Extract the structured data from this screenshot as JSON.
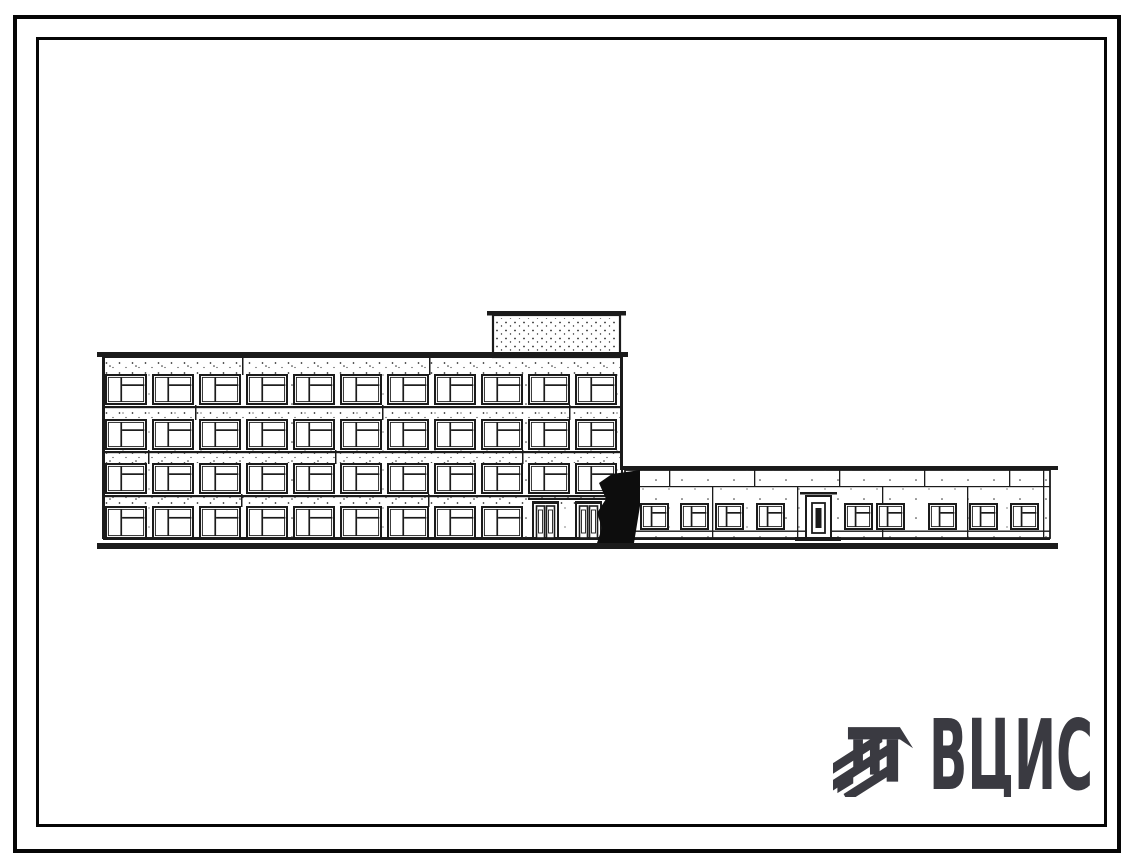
{
  "logo": {
    "text": "ВЦИС",
    "color": "#3a3a41",
    "icon": "hatched-shield-icon"
  },
  "drawing": {
    "subject": "Front elevation of a four-storey building with a roof penthouse and an attached single-storey wing",
    "main_block": {
      "floors": 4,
      "windows_per_upper_floor": 11,
      "ground_floor_windows": 9,
      "entrance_double_doors": 2,
      "roof_penthouse": 1
    },
    "wing": {
      "floors": 1,
      "windows": 9,
      "doors": 1
    },
    "geometry": {
      "ink": "#1b1b1b",
      "main": {
        "x": 103,
        "top": 357,
        "w": 519,
        "bottom": 538,
        "cap": [
          97,
          352,
          531,
          5
        ],
        "rows": [
          {
            "y": 375,
            "h": 29,
            "n": 11,
            "s": 1
          },
          {
            "y": 420,
            "h": 29,
            "n": 11,
            "s": 1
          },
          {
            "y": 464,
            "h": 29,
            "n": 11,
            "s": 1
          },
          {
            "y": 507,
            "h": 31,
            "n": 9,
            "s": 0
          }
        ],
        "win": {
          "x0": 106,
          "w": 40,
          "pitch": 47
        },
        "bands": [
          [
            359,
            15
          ],
          [
            406,
            13
          ],
          [
            451,
            12
          ],
          [
            495,
            11
          ]
        ],
        "band_joints": [
          [
            242,
            429
          ],
          [
            195,
            382,
            569
          ],
          [
            148,
            335,
            522
          ],
          [
            241,
            428,
            615
          ]
        ],
        "doors": {
          "y": 503,
          "h": 35,
          "w": 25,
          "xs": [
            533,
            576
          ],
          "canopy": [
            528,
            498,
            84,
            2
          ]
        },
        "penthouse": {
          "body": [
            493,
            315,
            127,
            42
          ],
          "cap": [
            487,
            311,
            139,
            4.5
          ]
        }
      },
      "wing": {
        "x": 625,
        "top": 470,
        "w": 425,
        "bottom": 538,
        "cap": [
          622,
          466,
          436,
          4
        ],
        "belt_y": 486,
        "sill_y": 530.5,
        "win": {
          "y": 504,
          "w": 27,
          "h": 25,
          "xs": [
            641,
            681,
            716,
            757,
            845,
            877,
            929,
            970,
            1011
          ]
        },
        "joints": [
          712,
          797,
          882,
          967
        ],
        "top_joints": [
          669,
          754,
          839,
          924,
          1009
        ],
        "end_joint_x": 1043,
        "door": {
          "x": 806,
          "y": 496,
          "w": 25,
          "h": 42,
          "sill": [
            795,
            537,
            46,
            4
          ],
          "canopy": [
            800,
            492,
            37,
            2.5
          ]
        }
      },
      "base_y": 538,
      "ground_bar": [
        97,
        543,
        961,
        6
      ],
      "shadow": "597,543 602,528 597,513 606,499 599,483 612,474 640,470 640,506 634,543"
    }
  }
}
